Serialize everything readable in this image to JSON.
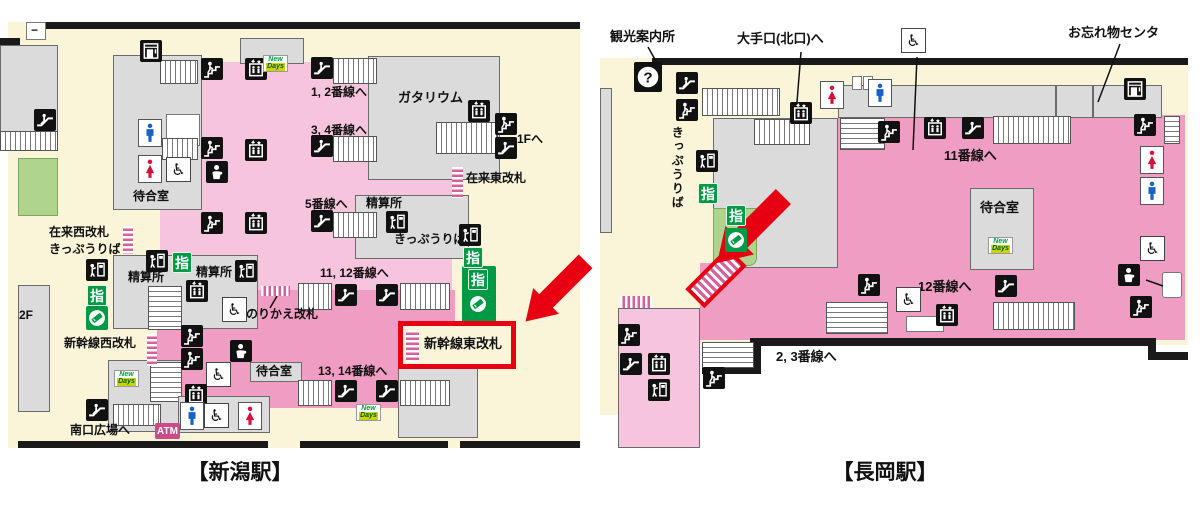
{
  "colors": {
    "cream": "#FAF5D9",
    "pink_light": "#F6C4DC",
    "pink_main": "#EF9DC3",
    "gray_room": "#DBDBDB",
    "green_area": "#AFD48E",
    "green_badge": "#009944",
    "red_highlight": "#E60012",
    "atm_pink": "#CE4A86",
    "men_blue": "#1660C8",
    "women_red": "#D6123C",
    "black": "#1a1a1a"
  },
  "brands": {
    "shitei": "指",
    "atm": "ATM",
    "question": "?",
    "wheelchair": "♿",
    "newdays_top": "New",
    "newdays_bottom": "Days"
  },
  "leader_lines": [
    [
      648,
      47,
      657,
      63
    ],
    [
      801,
      52,
      797,
      102
    ],
    [
      917,
      57,
      913,
      150
    ],
    [
      1120,
      44,
      1098,
      102
    ],
    [
      1146,
      280,
      1163,
      286
    ],
    [
      277,
      296,
      270,
      308
    ]
  ],
  "maps": {
    "niigata": {
      "caption": "【新潟駅】",
      "highlighted_gate": "新幹線東改札",
      "labels": [
        {
          "t": "−",
          "x": 31,
          "y": 24,
          "fs": 12
        },
        {
          "t": "1, 2番線へ",
          "x": 311,
          "y": 86
        },
        {
          "t": "ガタリウム",
          "x": 398,
          "y": 91,
          "fs": 13
        },
        {
          "t": "3, 4番線へ",
          "x": 311,
          "y": 124
        },
        {
          "t": "1Fへ",
          "x": 517,
          "y": 133
        },
        {
          "t": "在来東改札",
          "x": 466,
          "y": 172
        },
        {
          "t": "5番線へ",
          "x": 305,
          "y": 198
        },
        {
          "t": "精算所",
          "x": 366,
          "y": 197
        },
        {
          "t": "きっぷうりば",
          "x": 394,
          "y": 233
        },
        {
          "t": "待合室",
          "x": 133,
          "y": 190
        },
        {
          "t": "在来西改札",
          "x": 49,
          "y": 226
        },
        {
          "t": "きっぷうりば",
          "x": 49,
          "y": 243
        },
        {
          "t": "精算所",
          "x": 128,
          "y": 271
        },
        {
          "t": "精算所",
          "x": 196,
          "y": 266
        },
        {
          "t": "11, 12番線へ",
          "x": 320,
          "y": 267
        },
        {
          "t": "のりかえ改札",
          "x": 246,
          "y": 308
        },
        {
          "t": "2F",
          "x": 19,
          "y": 309
        },
        {
          "t": "新幹線西改札",
          "x": 64,
          "y": 337
        },
        {
          "t": "新幹線東改札",
          "x": 424,
          "y": 337,
          "fs": 13,
          "n": "highlighted-gate-label"
        },
        {
          "t": "待合室",
          "x": 256,
          "y": 365
        },
        {
          "t": "13, 14番線へ",
          "x": 318,
          "y": 365
        },
        {
          "t": "南口広場へ",
          "x": 70,
          "y": 424
        }
      ],
      "icons": [
        {
          "n": "coinlocker",
          "x": 140,
          "y": 40
        },
        {
          "n": "stairs-person",
          "x": 201,
          "y": 58
        },
        {
          "n": "elevator",
          "x": 245,
          "y": 58
        },
        {
          "n": "newdays",
          "x": 263,
          "y": 55
        },
        {
          "n": "escalator",
          "x": 311,
          "y": 57
        },
        {
          "n": "restroom-men",
          "x": 138,
          "y": 119
        },
        {
          "n": "restroom-women",
          "x": 138,
          "y": 155
        },
        {
          "n": "wheelchair",
          "x": 166,
          "y": 157
        },
        {
          "n": "stairs-person",
          "x": 201,
          "y": 137
        },
        {
          "n": "elevator",
          "x": 245,
          "y": 139
        },
        {
          "n": "baby",
          "x": 206,
          "y": 161
        },
        {
          "n": "escalator",
          "x": 311,
          "y": 135
        },
        {
          "n": "elevator",
          "x": 468,
          "y": 100
        },
        {
          "n": "stairs-person",
          "x": 495,
          "y": 113
        },
        {
          "n": "escalator",
          "x": 495,
          "y": 137
        },
        {
          "n": "stairs-person",
          "x": 201,
          "y": 212
        },
        {
          "n": "elevator",
          "x": 245,
          "y": 212
        },
        {
          "n": "escalator",
          "x": 311,
          "y": 210
        },
        {
          "n": "fare",
          "x": 386,
          "y": 211
        },
        {
          "n": "fare",
          "x": 459,
          "y": 224
        },
        {
          "n": "shitei",
          "x": 463,
          "y": 247
        },
        {
          "n": "shitei",
          "x": 468,
          "y": 269
        },
        {
          "n": "green-circle",
          "x": 467,
          "y": 292
        },
        {
          "n": "escalator",
          "x": 34,
          "y": 109
        },
        {
          "n": "fare",
          "x": 86,
          "y": 259
        },
        {
          "n": "shitei",
          "x": 87,
          "y": 285
        },
        {
          "n": "green-circle",
          "x": 86,
          "y": 306
        },
        {
          "n": "fare",
          "x": 146,
          "y": 250
        },
        {
          "n": "shitei",
          "x": 172,
          "y": 252
        },
        {
          "n": "fare",
          "x": 235,
          "y": 260
        },
        {
          "n": "elevator",
          "x": 186,
          "y": 280
        },
        {
          "n": "wheelchair",
          "x": 222,
          "y": 297
        },
        {
          "n": "stairs-person",
          "x": 181,
          "y": 325
        },
        {
          "n": "stairs-person",
          "x": 181,
          "y": 348
        },
        {
          "n": "baby",
          "x": 230,
          "y": 340
        },
        {
          "n": "wheelchair",
          "x": 206,
          "y": 362
        },
        {
          "n": "elevator",
          "x": 185,
          "y": 384
        },
        {
          "n": "escalator",
          "x": 86,
          "y": 399
        },
        {
          "n": "newdays",
          "x": 114,
          "y": 370
        },
        {
          "n": "atm",
          "x": 155,
          "y": 423
        },
        {
          "n": "restroom-men",
          "x": 180,
          "y": 402
        },
        {
          "n": "wheelchair",
          "x": 204,
          "y": 403
        },
        {
          "n": "restroom-women",
          "x": 238,
          "y": 402
        },
        {
          "n": "newdays",
          "x": 356,
          "y": 404
        },
        {
          "n": "escalator",
          "x": 335,
          "y": 284
        },
        {
          "n": "escalator",
          "x": 376,
          "y": 284
        },
        {
          "n": "escalator",
          "x": 335,
          "y": 380
        },
        {
          "n": "escalator",
          "x": 376,
          "y": 380
        }
      ]
    },
    "nagaoka": {
      "caption": "【長岡駅】",
      "labels": [
        {
          "t": "観光案内所",
          "x": 610,
          "y": 30,
          "fs": 13
        },
        {
          "t": "大手口(北口)へ",
          "x": 737,
          "y": 32,
          "fs": 13
        },
        {
          "t": "お忘れ物センタ",
          "x": 1068,
          "y": 26,
          "fs": 13
        },
        {
          "t": "きっぷうりば",
          "x": 670,
          "y": 126,
          "v": true
        },
        {
          "t": "11番線へ",
          "x": 944,
          "y": 149,
          "fs": 13
        },
        {
          "t": "待合室",
          "x": 980,
          "y": 201,
          "fs": 13
        },
        {
          "t": "12番線へ",
          "x": 918,
          "y": 280,
          "fs": 13
        },
        {
          "t": "2, 3番線へ",
          "x": 776,
          "y": 350,
          "fs": 13
        }
      ],
      "icons": [
        {
          "n": "question",
          "x": 634,
          "y": 62
        },
        {
          "n": "escalator",
          "x": 676,
          "y": 72
        },
        {
          "n": "stairs-person",
          "x": 676,
          "y": 99
        },
        {
          "n": "elevator",
          "x": 790,
          "y": 102
        },
        {
          "n": "restroom-women",
          "x": 820,
          "y": 81
        },
        {
          "n": "restroom-men",
          "x": 868,
          "y": 79
        },
        {
          "n": "wheelchair",
          "x": 901,
          "y": 28
        },
        {
          "n": "coinlocker",
          "x": 1124,
          "y": 78
        },
        {
          "n": "stairs-person",
          "x": 878,
          "y": 121
        },
        {
          "n": "elevator",
          "x": 924,
          "y": 117
        },
        {
          "n": "escalator",
          "x": 962,
          "y": 117
        },
        {
          "n": "stairs-person",
          "x": 1134,
          "y": 114
        },
        {
          "n": "restroom-women",
          "x": 1140,
          "y": 146
        },
        {
          "n": "restroom-men",
          "x": 1140,
          "y": 177
        },
        {
          "n": "wheelchair",
          "x": 1140,
          "y": 236
        },
        {
          "n": "baby",
          "x": 1118,
          "y": 264
        },
        {
          "n": "stairs-person",
          "x": 1130,
          "y": 296
        },
        {
          "n": "fare",
          "x": 696,
          "y": 150
        },
        {
          "n": "shitei",
          "x": 698,
          "y": 183
        },
        {
          "n": "shitei",
          "x": 726,
          "y": 205
        },
        {
          "n": "green-circle",
          "x": 725,
          "y": 228
        },
        {
          "n": "wheelchair",
          "x": 896,
          "y": 287
        },
        {
          "n": "stairs-person",
          "x": 858,
          "y": 274
        },
        {
          "n": "escalator",
          "x": 995,
          "y": 275
        },
        {
          "n": "elevator",
          "x": 936,
          "y": 304
        },
        {
          "n": "newdays",
          "x": 988,
          "y": 237
        },
        {
          "n": "stairs-person",
          "x": 618,
          "y": 324
        },
        {
          "n": "escalator",
          "x": 620,
          "y": 353
        },
        {
          "n": "elevator",
          "x": 648,
          "y": 353
        },
        {
          "n": "fare",
          "x": 648,
          "y": 379
        },
        {
          "n": "stairs-person",
          "x": 703,
          "y": 367
        }
      ]
    }
  }
}
